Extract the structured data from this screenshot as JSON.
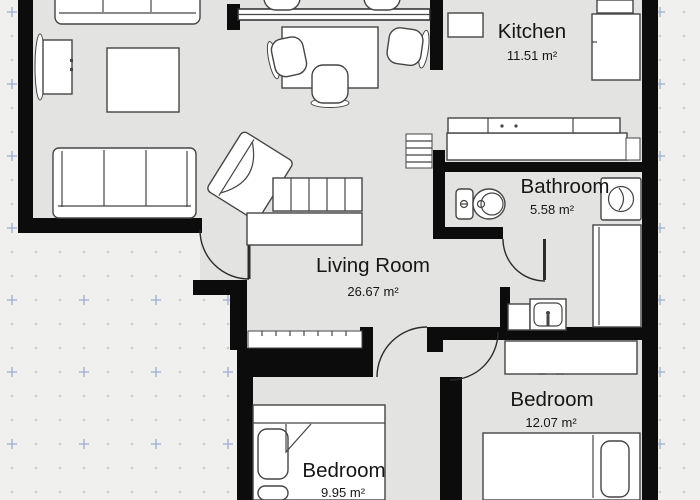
{
  "title": "Apartment floor plan",
  "colors": {
    "background": "#f0f0ee",
    "floor": "#e3e3e1",
    "wall": "#0c0c0c",
    "furnitureFill": "#ffffff",
    "furnitureStroke": "#454545",
    "doorStroke": "#2b2b2b",
    "text": "#161616",
    "gridDot": "#c9c9c7",
    "gridCross": "#aab6d8"
  },
  "rooms": [
    {
      "id": "kitchen",
      "name": "Kitchen",
      "area": "11.51 m²"
    },
    {
      "id": "bathroom",
      "name": "Bathroom",
      "area": "5.58 m²"
    },
    {
      "id": "living-room",
      "name": "Living Room",
      "area": "26.67 m²"
    },
    {
      "id": "bedroom-right",
      "name": "Bedroom",
      "area": "12.07 m²"
    },
    {
      "id": "bedroom-bottom",
      "name": "Bedroom",
      "area": "9.95 m²"
    }
  ],
  "fixtures": [
    "sofa-top",
    "sofa-left",
    "coffee-table",
    "tv-unit",
    "dining-table",
    "dining-chairs",
    "armchair",
    "shelf-unit",
    "sideboard",
    "radiator-living",
    "radiator-bedroom",
    "kitchen-counter",
    "kitchen-cabinet",
    "fridge",
    "toilet",
    "washing-machine",
    "shower",
    "bathroom-sink",
    "bathroom-counter",
    "wardrobe",
    "double-bed-right",
    "double-bed-bottom",
    "entry-door",
    "bathroom-door",
    "bedroom-doors",
    "window"
  ]
}
